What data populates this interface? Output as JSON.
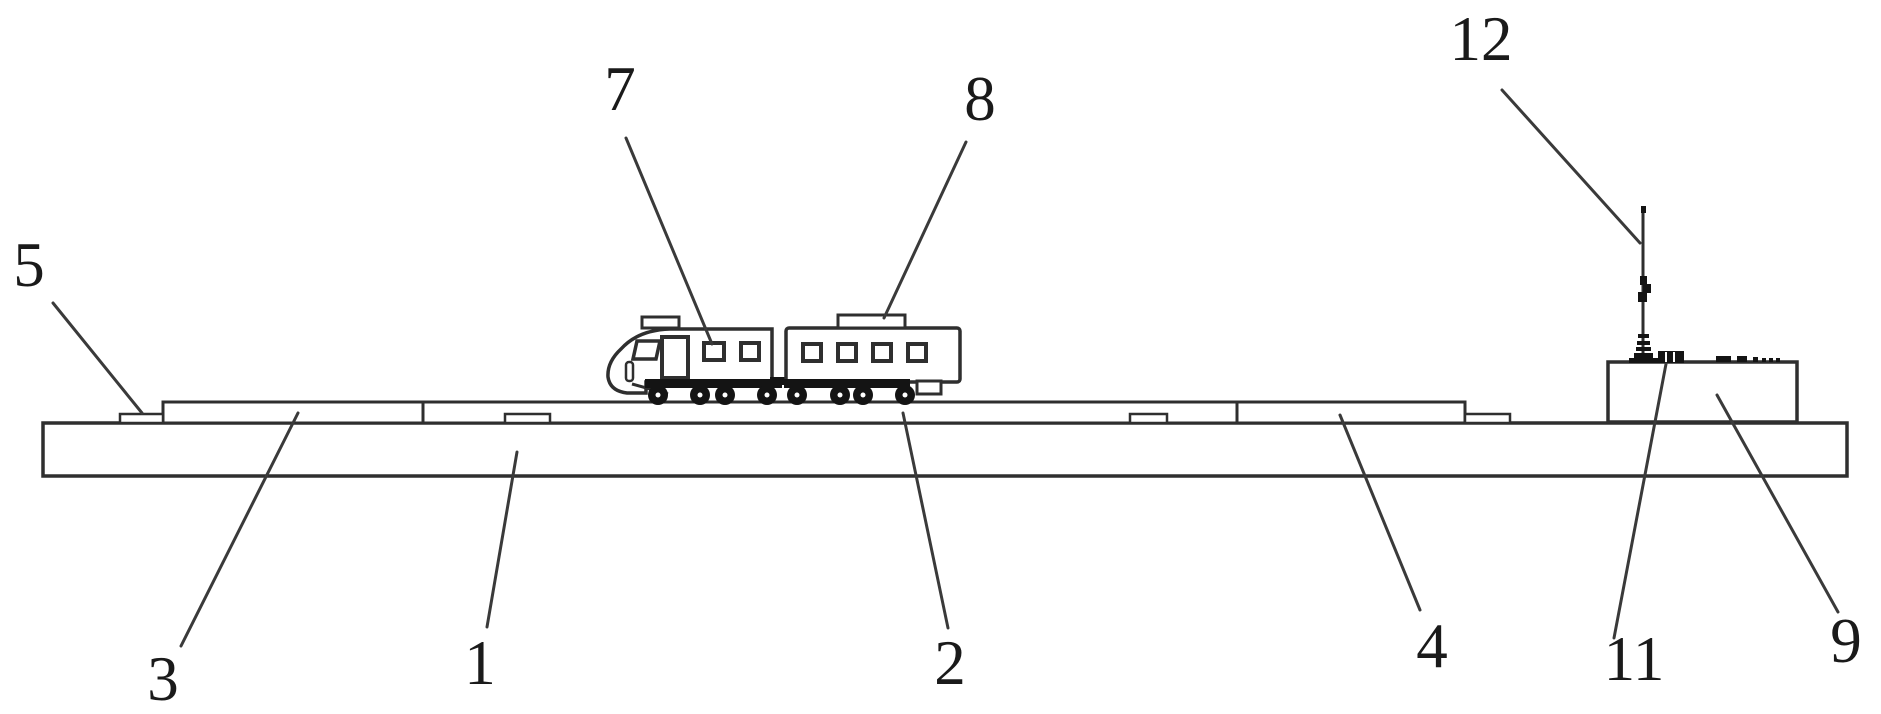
{
  "meta": {
    "background": "#ffffff",
    "line_color": "#2f2f2f",
    "solid_color": "#141414",
    "text_color": "#1a1a1a",
    "figure_type": "patent line drawing, side elevation"
  },
  "figure": {
    "reference_numerals": [
      "1",
      "2",
      "3",
      "4",
      "5",
      "7",
      "8",
      "9",
      "11",
      "12"
    ]
  },
  "labels": [
    {
      "text": "5",
      "x": 29,
      "y": 286,
      "leader": {
        "x1": 53,
        "y1": 303,
        "x2": 142,
        "y2": 413
      }
    },
    {
      "text": "7",
      "x": 620,
      "y": 110,
      "leader": {
        "x1": 626,
        "y1": 138,
        "x2": 712,
        "y2": 344
      }
    },
    {
      "text": "8",
      "x": 980,
      "y": 120,
      "leader": {
        "x1": 966,
        "y1": 142,
        "x2": 884,
        "y2": 318
      }
    },
    {
      "text": "12",
      "x": 1481,
      "y": 60,
      "leader": {
        "x1": 1502,
        "y1": 90,
        "x2": 1640,
        "y2": 243
      }
    },
    {
      "text": "3",
      "x": 163,
      "y": 700,
      "leader": {
        "x1": 181,
        "y1": 646,
        "x2": 298,
        "y2": 413
      }
    },
    {
      "text": "1",
      "x": 480,
      "y": 684,
      "leader": {
        "x1": 487,
        "y1": 627,
        "x2": 517,
        "y2": 452
      }
    },
    {
      "text": "2",
      "x": 950,
      "y": 684,
      "leader": {
        "x1": 948,
        "y1": 628,
        "x2": 903,
        "y2": 413
      }
    },
    {
      "text": "4",
      "x": 1432,
      "y": 667,
      "leader": {
        "x1": 1420,
        "y1": 610,
        "x2": 1340,
        "y2": 415
      }
    },
    {
      "text": "11",
      "x": 1634,
      "y": 680,
      "leader": {
        "x1": 1614,
        "y1": 638,
        "x2": 1666,
        "y2": 364
      }
    },
    {
      "text": "9",
      "x": 1846,
      "y": 662,
      "leader": {
        "x1": 1838,
        "y1": 612,
        "x2": 1717,
        "y2": 395
      }
    }
  ]
}
